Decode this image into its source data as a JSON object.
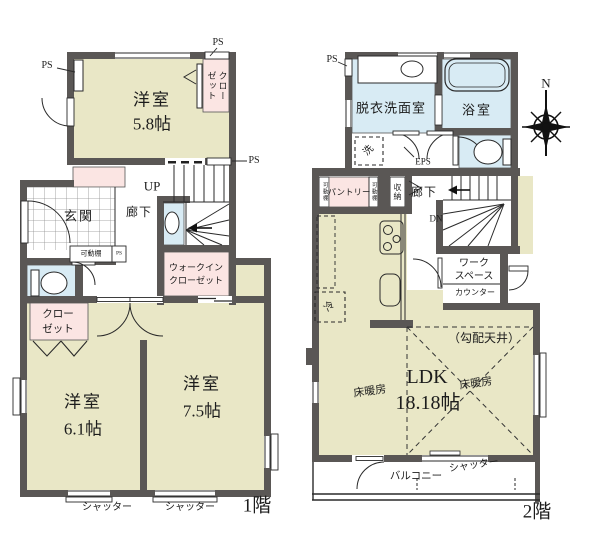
{
  "title": "間取り図",
  "colors": {
    "wall": "#5a5755",
    "room_cream": "#e9e7c6",
    "closet_pink": "#fbe5e3",
    "water_blue": "#d8ebf4",
    "line": "#2a2a2a"
  },
  "floor1": {
    "name": "1階",
    "labels": {
      "ps1": "PS",
      "ps2": "PS",
      "ps3": "PS",
      "ps4": "PS",
      "room58a": "洋室",
      "room58b": "5.8帖",
      "closet58a": "クロー",
      "closet58b": "ゼット",
      "up": "UP",
      "genkan": "玄関",
      "rouka": "廊下",
      "kadodana": "可動棚",
      "wica": "ウォークイン",
      "wicb": "クローゼット",
      "closeta": "クロー",
      "closetb": "ゼット",
      "room61a": "洋室",
      "room61b": "6.1帖",
      "room75a": "洋室",
      "room75b": "7.5帖",
      "shutter1": "シャッター",
      "shutter2": "シャッター"
    }
  },
  "floor2": {
    "name": "2階",
    "labels": {
      "ps": "PS",
      "datsui": "脱衣洗面室",
      "yokushitsu": "浴室",
      "sen": "洗",
      "eps": "EPS",
      "kadodana1": "可動棚",
      "pantry": "パントリー",
      "kadodana2": "可動棚",
      "shuno": "収納",
      "rouka": "廊下",
      "dn": "DN",
      "worka": "ワーク",
      "workb": "スペース",
      "counter": "カウンター",
      "rei": "冷",
      "koubai": "（勾配天井）",
      "ldk": "LDK",
      "ldksize": "18.18帖",
      "yuka1": "床暖房",
      "yuka2": "床暖房",
      "balcony": "バルコニー",
      "shutter": "シャッター"
    }
  },
  "compass": {
    "north": "N"
  }
}
